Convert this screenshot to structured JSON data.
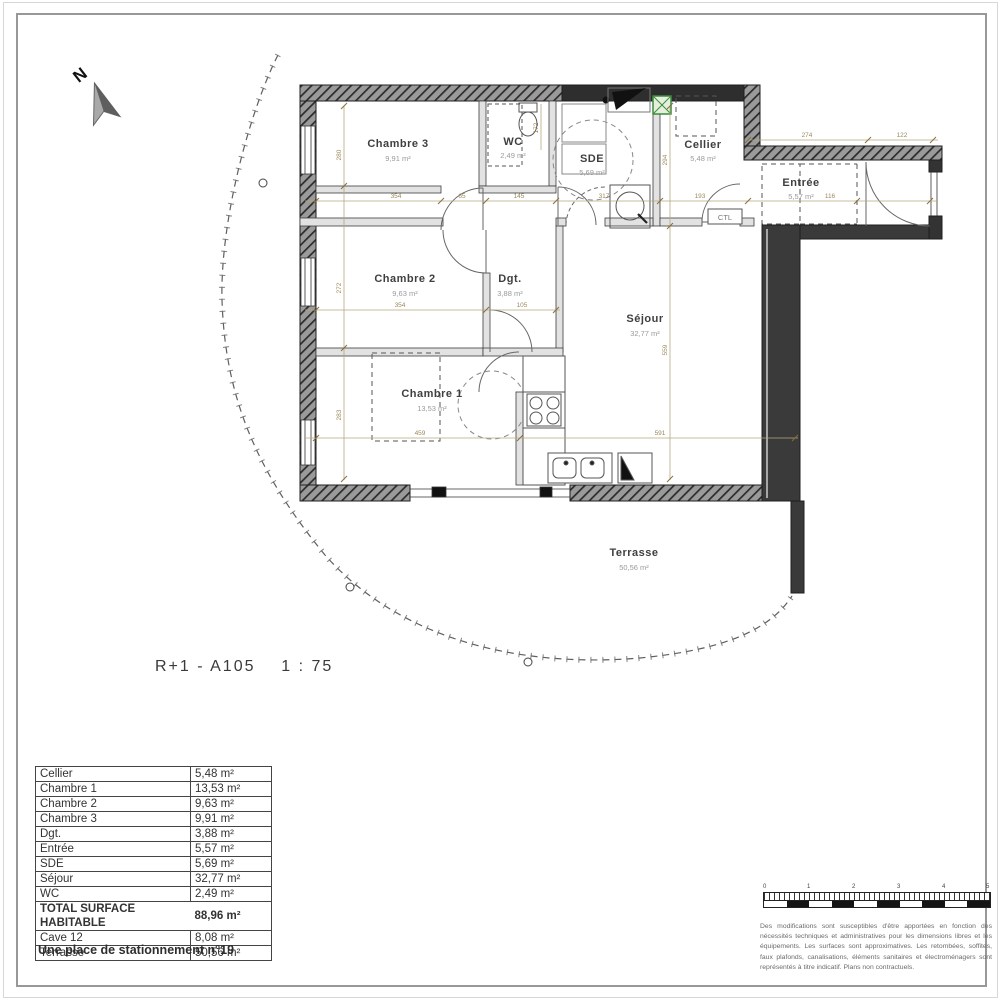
{
  "compass": {
    "label": "N"
  },
  "plan": {
    "title": "R+1 - A105    1 : 75",
    "rooms": {
      "chambre3": {
        "name": "Chambre 3",
        "area": "9,91 m²"
      },
      "wc": {
        "name": "WC",
        "area": "2,49 m²"
      },
      "sde": {
        "name": "SDE",
        "area": "5,69 m²"
      },
      "cellier": {
        "name": "Cellier",
        "area": "5,48 m²"
      },
      "entree": {
        "name": "Entrée",
        "area": "5,57 m²"
      },
      "chambre2": {
        "name": "Chambre 2",
        "area": "9,63 m²"
      },
      "dgt": {
        "name": "Dgt.",
        "area": "3,88 m²"
      },
      "sejour": {
        "name": "Séjour",
        "area": "32,77 m²"
      },
      "chambre1": {
        "name": "Chambre 1",
        "area": "13,53 m²"
      },
      "terrasse": {
        "name": "Terrasse",
        "area": "50,56 m²"
      }
    },
    "annotations": {
      "ctl": "CTL"
    },
    "dimensions": {
      "h1": {
        "a": "354",
        "b": "65",
        "c": "145",
        "d": "317",
        "e": "193",
        "f": "116"
      },
      "top": {
        "a": "274",
        "b": "122"
      },
      "h2": {
        "a": "354",
        "b": "105"
      },
      "h3": {
        "a": "459",
        "b": "591"
      },
      "vleft": {
        "a": "280",
        "b": "272",
        "c": "283"
      },
      "vright": {
        "a": "294",
        "b": "559"
      },
      "wc_h": "172"
    },
    "colors": {
      "vent_green": "#3d8b3d",
      "wall_dark": "#3a3a3a"
    }
  },
  "table": {
    "rows": [
      {
        "label": "Cellier",
        "value": "5,48 m²"
      },
      {
        "label": "Chambre 1",
        "value": "13,53 m²"
      },
      {
        "label": "Chambre 2",
        "value": "9,63 m²"
      },
      {
        "label": "Chambre 3",
        "value": "9,91 m²"
      },
      {
        "label": "Dgt.",
        "value": "3,88 m²"
      },
      {
        "label": "Entrée",
        "value": "5,57 m²"
      },
      {
        "label": "SDE",
        "value": "5,69 m²"
      },
      {
        "label": "Séjour",
        "value": "32,77 m²"
      },
      {
        "label": "WC",
        "value": "2,49 m²"
      },
      {
        "label": "TOTAL SURFACE HABITABLE",
        "value": "88,96 m²"
      },
      {
        "label": "Cave 12",
        "value": "8,08 m²"
      },
      {
        "label": "Terrasse",
        "value": "50,56 m²"
      }
    ]
  },
  "parking_note": "Une place de stationnement n°19",
  "scalebar": {
    "ticks": [
      "0",
      "1",
      "2",
      "3",
      "4",
      "5"
    ]
  },
  "disclaimer": "Des modifications sont susceptibles d'être apportées en fonction des nécessités techniques et administratives pour les dimensions libres et les équipements. Les surfaces sont approximatives. Les retombées, soffites, faux plafonds, canalisations, éléments sanitaires et électroménagers sont représentés à titre indicatif. Plans non contractuels."
}
